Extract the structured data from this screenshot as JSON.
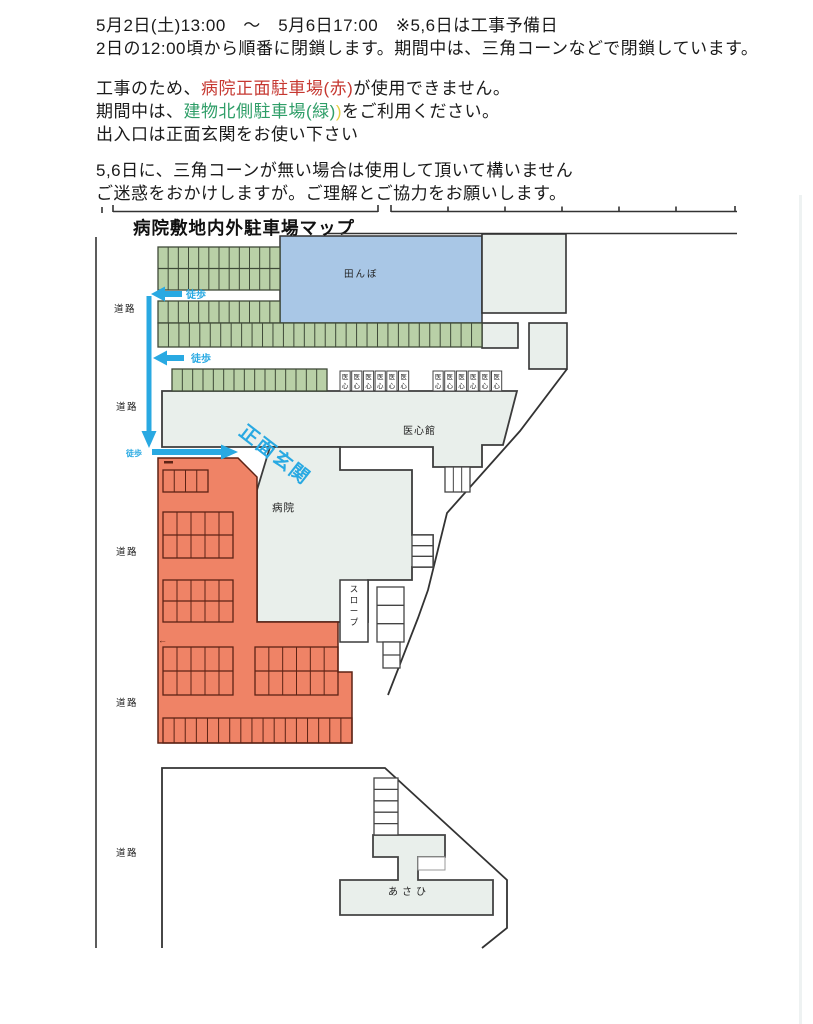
{
  "notice": {
    "line1": "5月2日(土)13:00　～　5月6日17:00　※5,6日は工事予備日",
    "line2": "2日の12:00頃から順番に閉鎖します。期間中は、三角コーンなどで閉鎖しています。",
    "line3_pre": "工事のため、",
    "line3_red": "病院正面駐車場(赤)",
    "line3_post": "が使用できません。",
    "line4_pre": "期間中は、",
    "line4_green": "建物北側駐車場(緑)",
    "line4_yellow": ")",
    "line4_post": "をご利用ください。",
    "line5": "出入口は正面玄関をお使い下さい",
    "line6": "5,6日に、三角コーンが無い場合は使用して頂いて構いません",
    "line7": "ご迷惑をおかけしますが。ご理解とご協力をお願いします。"
  },
  "map": {
    "title": "病院敷地内外駐車場マップ",
    "labels": {
      "road": "道路",
      "rice_field": "田んぼ",
      "ishinkan": "医心館",
      "hospital": "病院",
      "walk": "徒歩",
      "main_entrance": "正面玄関",
      "asahi": "あさひ",
      "slope": "スロープ",
      "ishin": "医心",
      "left_arrow_mark": "←"
    },
    "colors": {
      "green_lot": "#b9d0a7",
      "green_line": "#3f4a38",
      "red_lot": "#ef8366",
      "red_line": "#5d2315",
      "blue_field": "#a9c7e6",
      "building": "#e9efeb",
      "outline": "#333333",
      "arrow_blue": "#29a9e2"
    },
    "grids": [
      {
        "name": "green-lot-a",
        "x": 158,
        "y": 247,
        "w": 122,
        "h": 43,
        "cols": 12,
        "rows": 2,
        "fill": "#b9d0a7",
        "stroke": "#3f4a38"
      },
      {
        "name": "green-lot-b1",
        "x": 158,
        "y": 301,
        "w": 122,
        "h": 22,
        "cols": 12,
        "rows": 1,
        "fill": "#b9d0a7",
        "stroke": "#3f4a38"
      },
      {
        "name": "green-lot-b2",
        "x": 158,
        "y": 323,
        "w": 324,
        "h": 24,
        "cols": 31,
        "rows": 1,
        "fill": "#b9d0a7",
        "stroke": "#3f4a38"
      },
      {
        "name": "green-lot-c",
        "x": 172,
        "y": 369,
        "w": 155,
        "h": 22,
        "cols": 15,
        "rows": 1,
        "fill": "#b9d0a7",
        "stroke": "#3f4a38"
      },
      {
        "name": "red-stalls-1",
        "x": 163,
        "y": 470,
        "w": 45,
        "h": 22,
        "cols": 4,
        "rows": 1,
        "fill": "none",
        "stroke": "#5d2315"
      },
      {
        "name": "red-stalls-2",
        "x": 163,
        "y": 512,
        "w": 70,
        "h": 46,
        "cols": 5,
        "rows": 2,
        "fill": "none",
        "stroke": "#5d2315"
      },
      {
        "name": "red-stalls-3",
        "x": 163,
        "y": 580,
        "w": 70,
        "h": 42,
        "cols": 5,
        "rows": 2,
        "fill": "none",
        "stroke": "#5d2315"
      },
      {
        "name": "red-stalls-4",
        "x": 163,
        "y": 647,
        "w": 70,
        "h": 48,
        "cols": 5,
        "rows": 2,
        "fill": "none",
        "stroke": "#5d2315"
      },
      {
        "name": "red-stalls-5",
        "x": 255,
        "y": 647,
        "w": 83,
        "h": 48,
        "cols": 6,
        "rows": 2,
        "fill": "none",
        "stroke": "#5d2315"
      },
      {
        "name": "red-stalls-6",
        "x": 163,
        "y": 718,
        "w": 189,
        "h": 25,
        "cols": 17,
        "rows": 1,
        "fill": "none",
        "stroke": "#5d2315"
      },
      {
        "name": "ishinkan-step-box",
        "x": 445,
        "y": 467,
        "w": 25,
        "h": 25,
        "cols": 3,
        "rows": 1,
        "fill": "#ffffff",
        "stroke": "#444444"
      },
      {
        "name": "hospital-stairs",
        "x": 412,
        "y": 535,
        "w": 21,
        "h": 32,
        "cols": 1,
        "rows": 3,
        "fill": "#ffffff",
        "stroke": "#444444"
      },
      {
        "name": "slope-steps-upper",
        "x": 377,
        "y": 587,
        "w": 27,
        "h": 55,
        "cols": 1,
        "rows": 3,
        "fill": "#ffffff",
        "stroke": "#444444"
      },
      {
        "name": "slope-steps-lower",
        "x": 383,
        "y": 642,
        "w": 17,
        "h": 26,
        "cols": 1,
        "rows": 2,
        "fill": "#ffffff",
        "stroke": "#444444"
      },
      {
        "name": "asahi-stairs",
        "x": 374,
        "y": 778,
        "w": 24,
        "h": 57,
        "cols": 1,
        "rows": 5,
        "fill": "#ffffff",
        "stroke": "#444444"
      }
    ],
    "ishin_groups": [
      {
        "x": 340,
        "y": 371,
        "count": 6,
        "w": 10.2,
        "pitch": 11.7,
        "h": 20
      },
      {
        "x": 433,
        "y": 371,
        "count": 6,
        "w": 10.2,
        "pitch": 11.7,
        "h": 20
      }
    ],
    "vertical_labels": [
      {
        "key": "slope",
        "text": "スロープ",
        "x": 354,
        "y": 592,
        "size": 8.5
      }
    ]
  }
}
